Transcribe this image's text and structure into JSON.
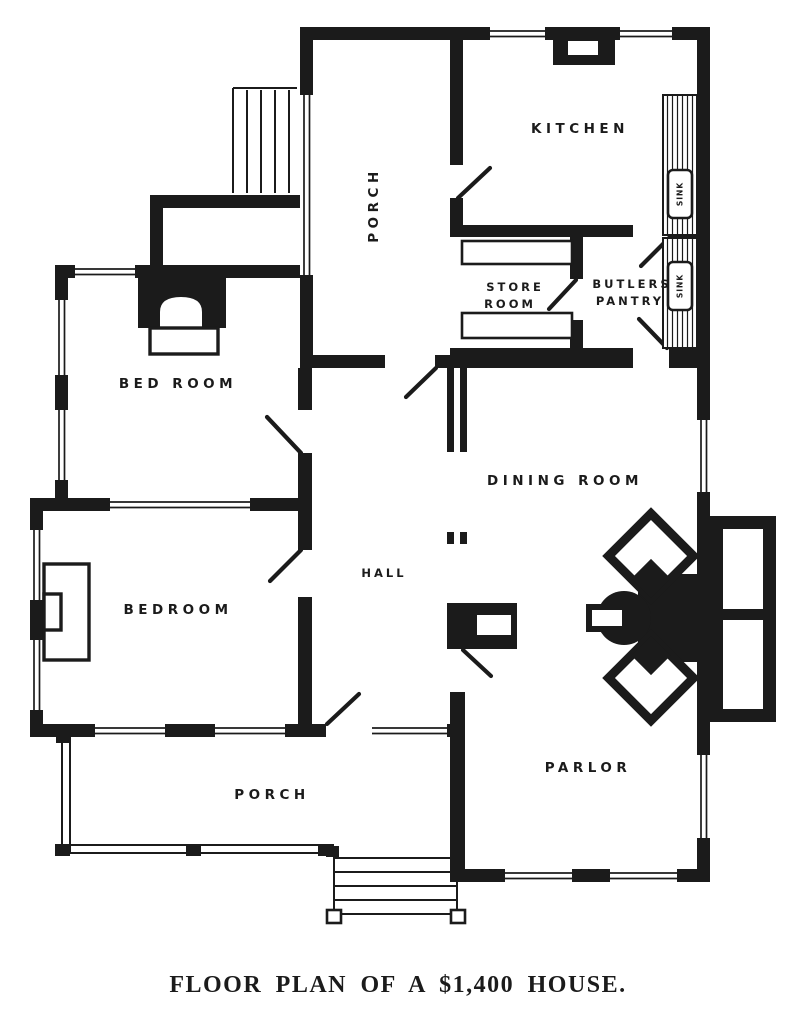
{
  "title": {
    "caption": "FLOOR PLAN OF A $1,400 HOUSE."
  },
  "labels": {
    "kitchen": "KITCHEN",
    "porch_upper": "PORCH",
    "store_room_line1": "STORE",
    "store_room_line2": "ROOM",
    "butlers_pantry_line1": "BUTLERS",
    "butlers_pantry_line2": "PANTRY",
    "sink_kitchen": "SINK",
    "sink_pantry": "SINK",
    "bed_room_upper": "BED ROOM",
    "bed_room_lower": "BEDROOM",
    "hall": "HALL",
    "dining_room": "DINING ROOM",
    "parlor": "PARLOR",
    "porch_lower": "PORCH"
  },
  "colors": {
    "ink": "#1b1b1b",
    "paper": "#ffffff"
  }
}
